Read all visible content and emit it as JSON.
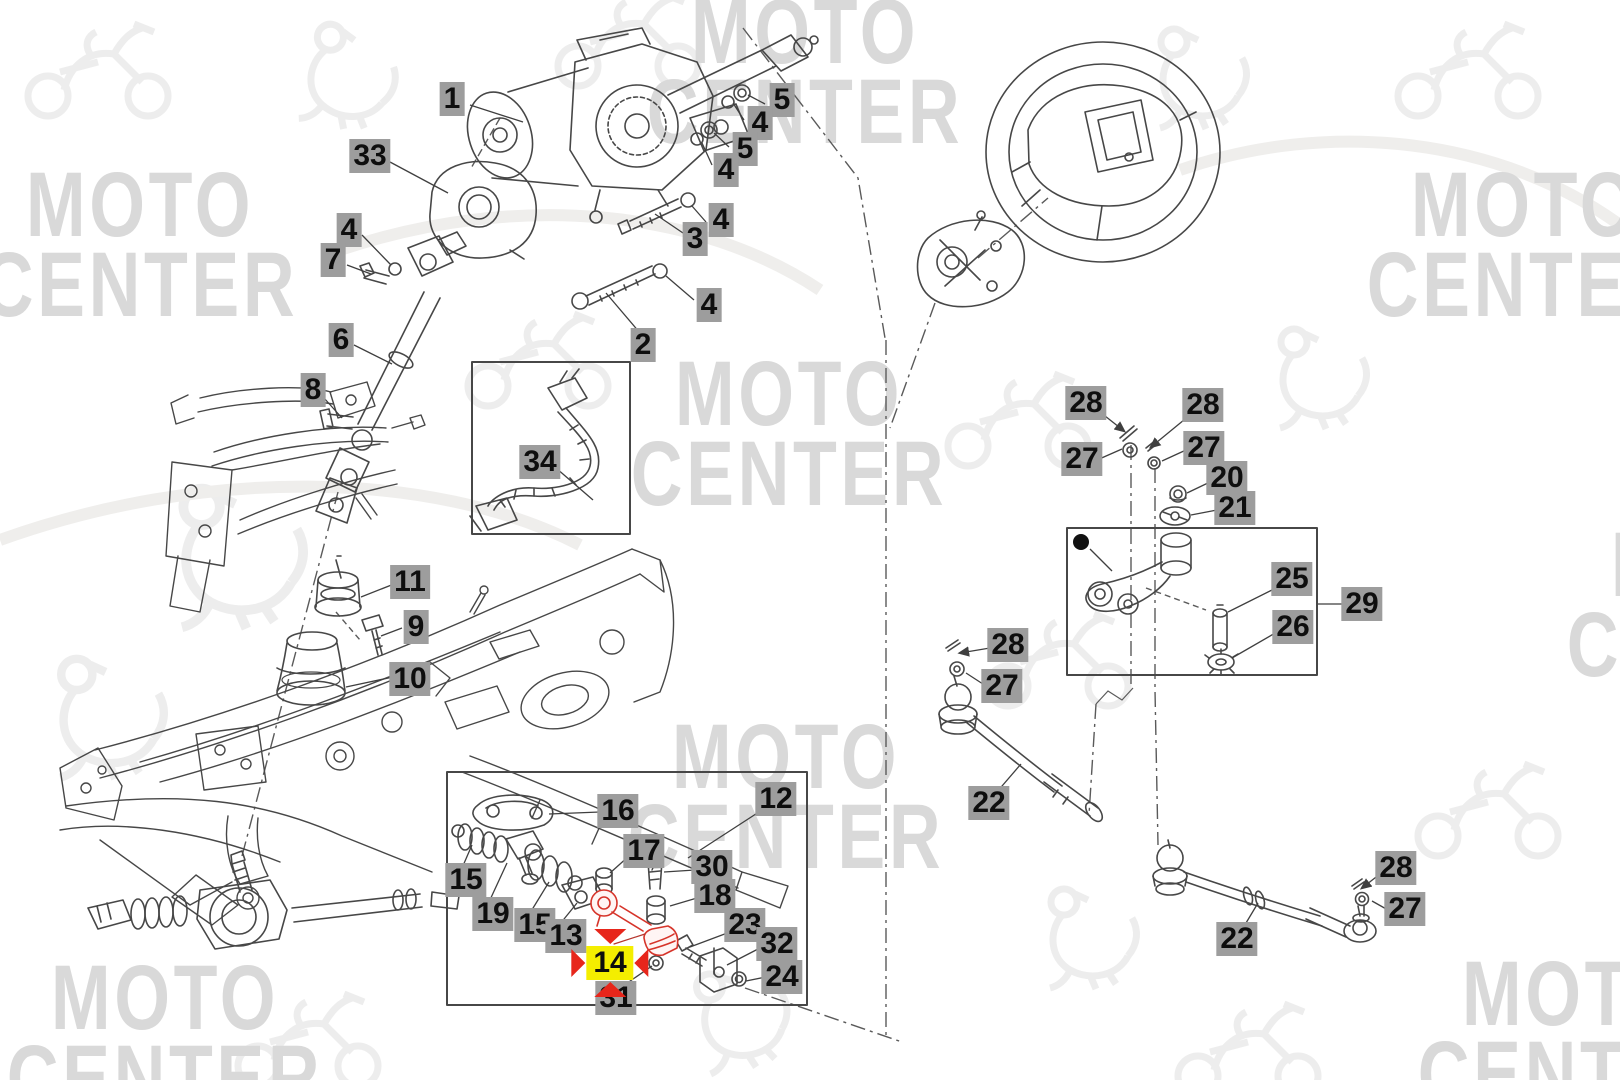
{
  "watermark": {
    "line1": "MOTO",
    "line2": "CENTER",
    "color": "#d9d9d9",
    "positions": [
      {
        "x": 805,
        "y": 72
      },
      {
        "x": 140,
        "y": 245
      },
      {
        "x": 1525,
        "y": 245
      },
      {
        "x": 789,
        "y": 434
      },
      {
        "x": 1725,
        "y": 605
      },
      {
        "x": 786,
        "y": 797
      },
      {
        "x": 165,
        "y": 1038
      },
      {
        "x": 1576,
        "y": 1034
      }
    ]
  },
  "diagram": {
    "highlighted_part": "14",
    "colors": {
      "chip_background": "#9d9d9d",
      "chip_text": "#0e0e0e",
      "highlight_background": "#f4ee00",
      "highlight_arrows": "#e7261b",
      "highlighted_part_outline": "#d6342a",
      "line_art": "#474747"
    },
    "labels": [
      {
        "n": "1",
        "x": 452,
        "y": 99
      },
      {
        "n": "33",
        "x": 370,
        "y": 156
      },
      {
        "n": "5",
        "x": 782,
        "y": 100
      },
      {
        "n": "4",
        "x": 760,
        "y": 123
      },
      {
        "n": "5",
        "x": 745,
        "y": 149
      },
      {
        "n": "4",
        "x": 726,
        "y": 170
      },
      {
        "n": "4",
        "x": 721,
        "y": 220
      },
      {
        "n": "3",
        "x": 695,
        "y": 239
      },
      {
        "n": "4",
        "x": 709,
        "y": 305
      },
      {
        "n": "2",
        "x": 643,
        "y": 345
      },
      {
        "n": "4",
        "x": 349,
        "y": 230
      },
      {
        "n": "7",
        "x": 333,
        "y": 260
      },
      {
        "n": "6",
        "x": 341,
        "y": 340
      },
      {
        "n": "8",
        "x": 313,
        "y": 390
      },
      {
        "n": "34",
        "x": 540,
        "y": 462
      },
      {
        "n": "11",
        "x": 410,
        "y": 582
      },
      {
        "n": "9",
        "x": 416,
        "y": 627
      },
      {
        "n": "10",
        "x": 410,
        "y": 679
      },
      {
        "n": "28",
        "x": 1086,
        "y": 403
      },
      {
        "n": "28",
        "x": 1203,
        "y": 405
      },
      {
        "n": "27",
        "x": 1082,
        "y": 459
      },
      {
        "n": "27",
        "x": 1204,
        "y": 448
      },
      {
        "n": "20",
        "x": 1227,
        "y": 478
      },
      {
        "n": "21",
        "x": 1235,
        "y": 508
      },
      {
        "n": "25",
        "x": 1292,
        "y": 579
      },
      {
        "n": "26",
        "x": 1293,
        "y": 627
      },
      {
        "n": "29",
        "x": 1362,
        "y": 604
      },
      {
        "n": "28",
        "x": 1008,
        "y": 645
      },
      {
        "n": "27",
        "x": 1002,
        "y": 686
      },
      {
        "n": "22",
        "x": 989,
        "y": 803
      },
      {
        "n": "12",
        "x": 776,
        "y": 799
      },
      {
        "n": "16",
        "x": 618,
        "y": 811
      },
      {
        "n": "17",
        "x": 644,
        "y": 851
      },
      {
        "n": "30",
        "x": 712,
        "y": 867
      },
      {
        "n": "18",
        "x": 715,
        "y": 896
      },
      {
        "n": "15",
        "x": 466,
        "y": 880
      },
      {
        "n": "19",
        "x": 493,
        "y": 914
      },
      {
        "n": "15",
        "x": 535,
        "y": 925
      },
      {
        "n": "13",
        "x": 566,
        "y": 936
      },
      {
        "n": "23",
        "x": 745,
        "y": 925
      },
      {
        "n": "32",
        "x": 777,
        "y": 944
      },
      {
        "n": "24",
        "x": 782,
        "y": 977
      },
      {
        "n": "14",
        "x": 610,
        "y": 963,
        "hl": true
      },
      {
        "n": "31",
        "x": 616,
        "y": 998
      },
      {
        "n": "22",
        "x": 1237,
        "y": 939
      },
      {
        "n": "28",
        "x": 1396,
        "y": 868
      },
      {
        "n": "27",
        "x": 1405,
        "y": 909
      }
    ]
  }
}
